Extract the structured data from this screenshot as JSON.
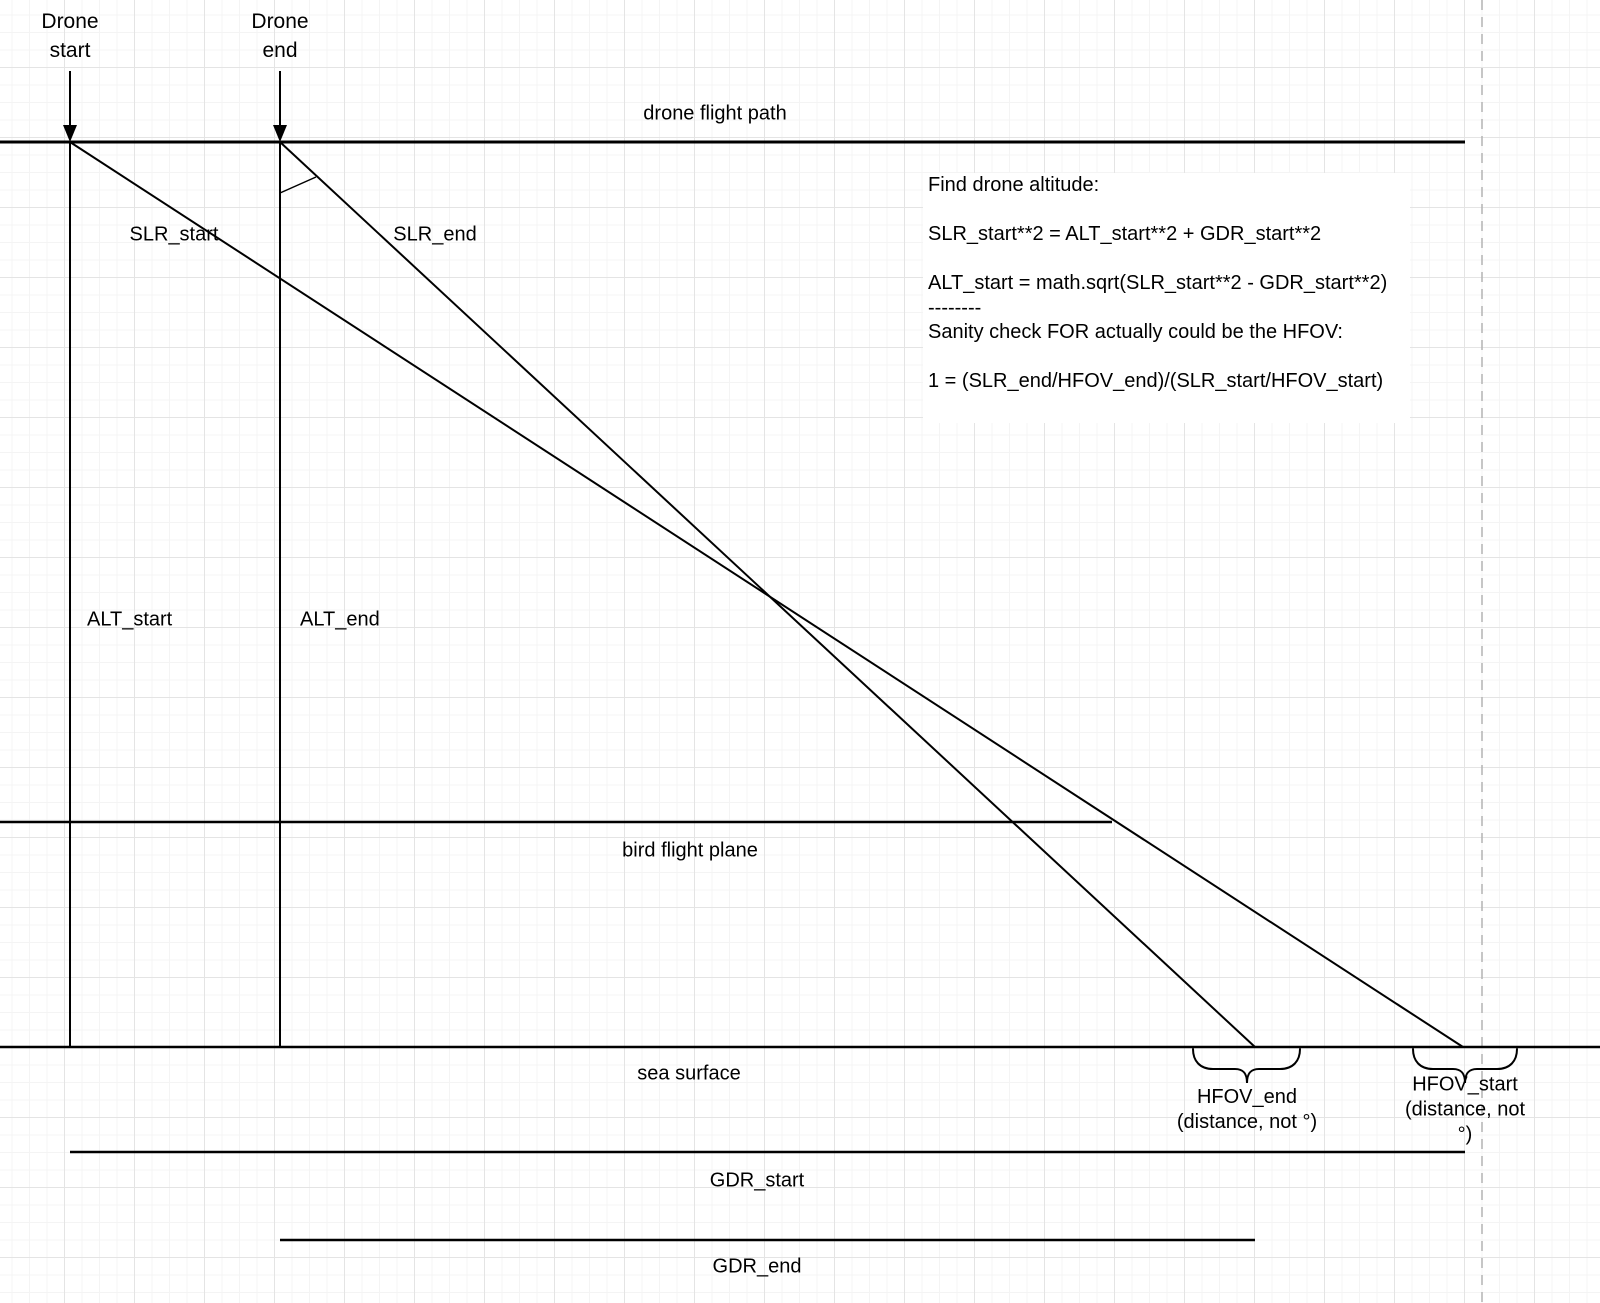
{
  "labels": {
    "drone_start": "Drone\nstart",
    "drone_end": "Drone\nend",
    "flight_path": "drone flight path",
    "slr_start": "SLR_start",
    "slr_end": "SLR_end",
    "alt_start": "ALT_start",
    "alt_end": "ALT_end",
    "bird_plane": "bird flight plane",
    "sea_surface": "sea surface",
    "gdr_start": "GDR_start",
    "gdr_end": "GDR_end",
    "hfov_end": "HFOV_end\n(distance, not °)",
    "hfov_start": "HFOV_start\n(distance, not °)"
  },
  "note": {
    "text": "Find drone altitude:\n\nSLR_start**2 = ALT_start**2 + GDR_start**2\n\nALT_start = math.sqrt(SLR_start**2 - GDR_start**2)\n--------\nSanity check FOR actually could be the HFOV:\n\n1 = (SLR_end/HFOV_end)/(SLR_start/HFOV_start)"
  },
  "colors": {
    "line": "#000000",
    "grid_minor": "#f4f4f4",
    "grid_major": "#e4e4e4",
    "dashed_guide": "#b3b3b3",
    "background": "#ffffff"
  }
}
